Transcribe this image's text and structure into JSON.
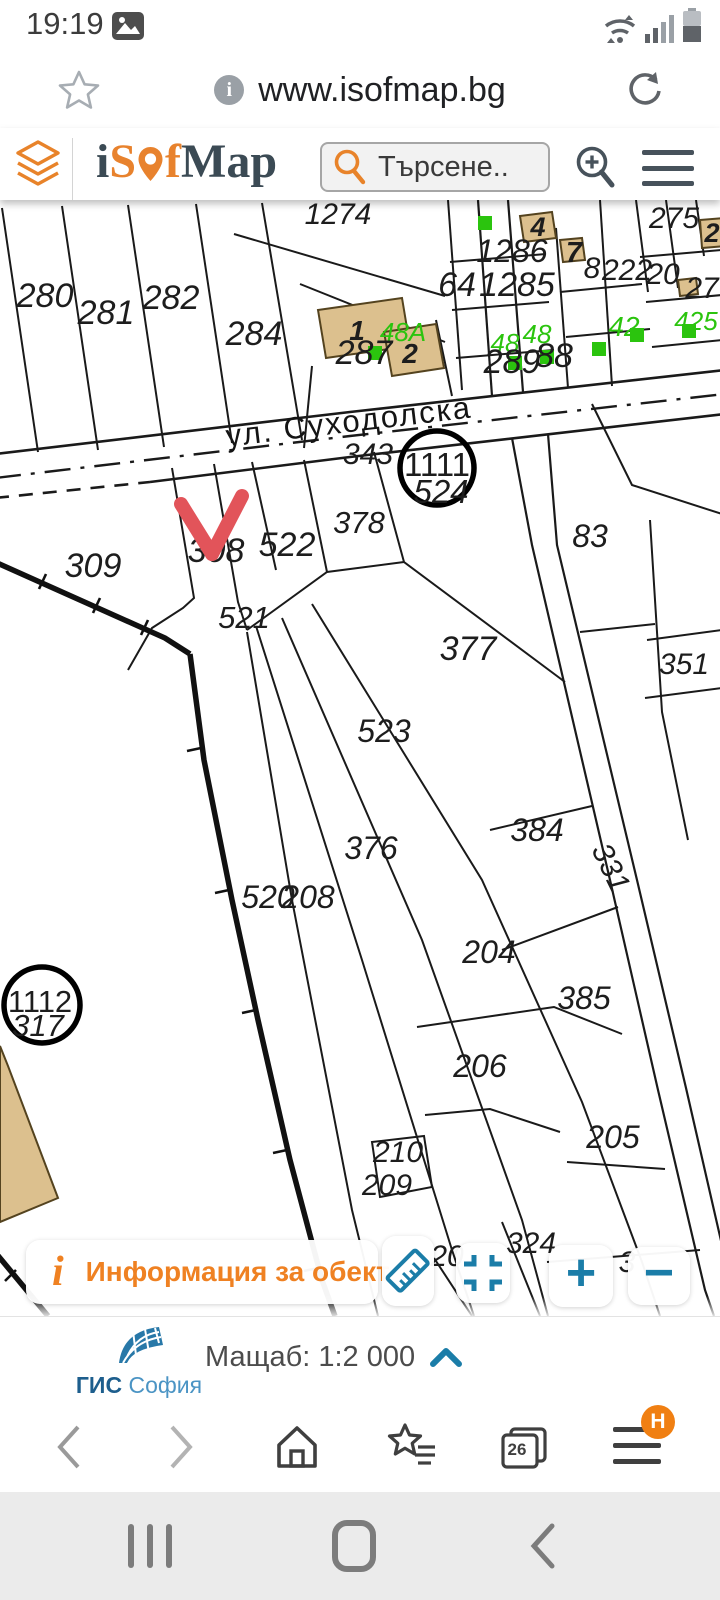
{
  "status_bar": {
    "time": "19:19"
  },
  "address_bar": {
    "url": "www.isofmap.bg",
    "info_badge": "i"
  },
  "header": {
    "logo": {
      "p1": "i",
      "p2": "S",
      "p3": "f",
      "p4": "Map"
    },
    "search_placeholder": "Търсене.."
  },
  "map": {
    "street_name": "ул. Суходолска",
    "colors": {
      "green": "#2bc40e",
      "tan": "#dcc08e",
      "tan_border": "#54431f",
      "red_check": "#e2545a",
      "line": "#1a1a1a"
    },
    "labels": [
      {
        "t": "1274",
        "x": 338,
        "y": 24,
        "s": 30
      },
      {
        "t": "280",
        "x": 45,
        "y": 107,
        "s": 34
      },
      {
        "t": "281",
        "x": 106,
        "y": 124,
        "s": 34
      },
      {
        "t": "282",
        "x": 171,
        "y": 109,
        "s": 34
      },
      {
        "t": "284",
        "x": 254,
        "y": 145,
        "s": 34
      },
      {
        "t": "275",
        "x": 674,
        "y": 28,
        "s": 30
      },
      {
        "t": "4",
        "x": 538,
        "y": 36,
        "s": 27,
        "b": true
      },
      {
        "t": "2",
        "x": 712,
        "y": 42,
        "s": 27,
        "b": true
      },
      {
        "t": "1286",
        "x": 512,
        "y": 62,
        "s": 32
      },
      {
        "t": "7",
        "x": 574,
        "y": 62,
        "s": 29,
        "b": true
      },
      {
        "t": "8",
        "x": 592,
        "y": 78,
        "s": 30
      },
      {
        "t": "222",
        "x": 627,
        "y": 80,
        "s": 30
      },
      {
        "t": "20",
        "x": 663,
        "y": 84,
        "s": 30
      },
      {
        "t": "64",
        "x": 457,
        "y": 96,
        "s": 34
      },
      {
        "t": "1285",
        "x": 517,
        "y": 96,
        "s": 34
      },
      {
        "t": "27",
        "x": 702,
        "y": 98,
        "s": 30
      },
      {
        "t": "48A",
        "x": 403,
        "y": 141,
        "s": 26,
        "c": "green"
      },
      {
        "t": "48",
        "x": 537,
        "y": 143,
        "s": 26,
        "c": "green"
      },
      {
        "t": "48",
        "x": 505,
        "y": 152,
        "s": 26,
        "c": "green"
      },
      {
        "t": "42",
        "x": 624,
        "y": 136,
        "s": 28,
        "c": "green"
      },
      {
        "t": "425",
        "x": 696,
        "y": 130,
        "s": 26,
        "c": "green"
      },
      {
        "t": "1",
        "x": 357,
        "y": 140,
        "s": 28,
        "b": true
      },
      {
        "t": "2",
        "x": 410,
        "y": 163,
        "s": 28,
        "b": true
      },
      {
        "t": "287",
        "x": 364,
        "y": 164,
        "s": 34
      },
      {
        "t": "289",
        "x": 512,
        "y": 173,
        "s": 34
      },
      {
        "t": "88",
        "x": 554,
        "y": 167,
        "s": 34
      },
      {
        "t": "343",
        "x": 368,
        "y": 264,
        "s": 30
      },
      {
        "t": "1111",
        "x": 437,
        "y": 276,
        "s": 33,
        "up": true
      },
      {
        "t": "524",
        "x": 441,
        "y": 303,
        "s": 33
      },
      {
        "t": "378",
        "x": 359,
        "y": 333,
        "s": 31
      },
      {
        "t": "83",
        "x": 590,
        "y": 347,
        "s": 32
      },
      {
        "t": "308",
        "x": 216,
        "y": 362,
        "s": 34
      },
      {
        "t": "522",
        "x": 287,
        "y": 356,
        "s": 34
      },
      {
        "t": "309",
        "x": 93,
        "y": 377,
        "s": 34
      },
      {
        "t": "521",
        "x": 244,
        "y": 428,
        "s": 31
      },
      {
        "t": "377",
        "x": 468,
        "y": 460,
        "s": 34
      },
      {
        "t": "351",
        "x": 684,
        "y": 474,
        "s": 30
      },
      {
        "t": "523",
        "x": 384,
        "y": 542,
        "s": 32
      },
      {
        "t": "376",
        "x": 371,
        "y": 659,
        "s": 32
      },
      {
        "t": "384",
        "x": 537,
        "y": 641,
        "s": 32
      },
      {
        "t": "331",
        "x": 602,
        "y": 672,
        "s": 30,
        "r": 64
      },
      {
        "t": "520",
        "x": 268,
        "y": 708,
        "s": 32
      },
      {
        "t": "208",
        "x": 308,
        "y": 708,
        "s": 32
      },
      {
        "t": "204",
        "x": 489,
        "y": 763,
        "s": 32
      },
      {
        "t": "1112",
        "x": 40,
        "y": 812,
        "s": 31,
        "up": true
      },
      {
        "t": "317",
        "x": 38,
        "y": 836,
        "s": 31
      },
      {
        "t": "385",
        "x": 584,
        "y": 809,
        "s": 32
      },
      {
        "t": "206",
        "x": 480,
        "y": 877,
        "s": 32
      },
      {
        "t": "205",
        "x": 613,
        "y": 948,
        "s": 32
      },
      {
        "t": "210",
        "x": 398,
        "y": 962,
        "s": 30
      },
      {
        "t": "209",
        "x": 387,
        "y": 995,
        "s": 30
      },
      {
        "t": "324",
        "x": 531,
        "y": 1053,
        "s": 30
      },
      {
        "t": "20",
        "x": 447,
        "y": 1066,
        "s": 30
      },
      {
        "t": "3",
        "x": 627,
        "y": 1072,
        "s": 30
      }
    ],
    "green_squares": [
      [
        478,
        16
      ],
      [
        368,
        146
      ],
      [
        508,
        156
      ],
      [
        540,
        150
      ],
      [
        592,
        142
      ],
      [
        630,
        128
      ],
      [
        682,
        124
      ]
    ]
  },
  "controls": {
    "info_icon": "i",
    "info_label": "Информация за обект",
    "zoom_in": "+",
    "zoom_out": "−"
  },
  "footer": {
    "brand_bold": "ГИС",
    "brand_light": " София",
    "scale_label": "Мащаб: 1:2 000"
  },
  "browser_nav": {
    "tab_count": "26",
    "menu_badge": "H"
  }
}
